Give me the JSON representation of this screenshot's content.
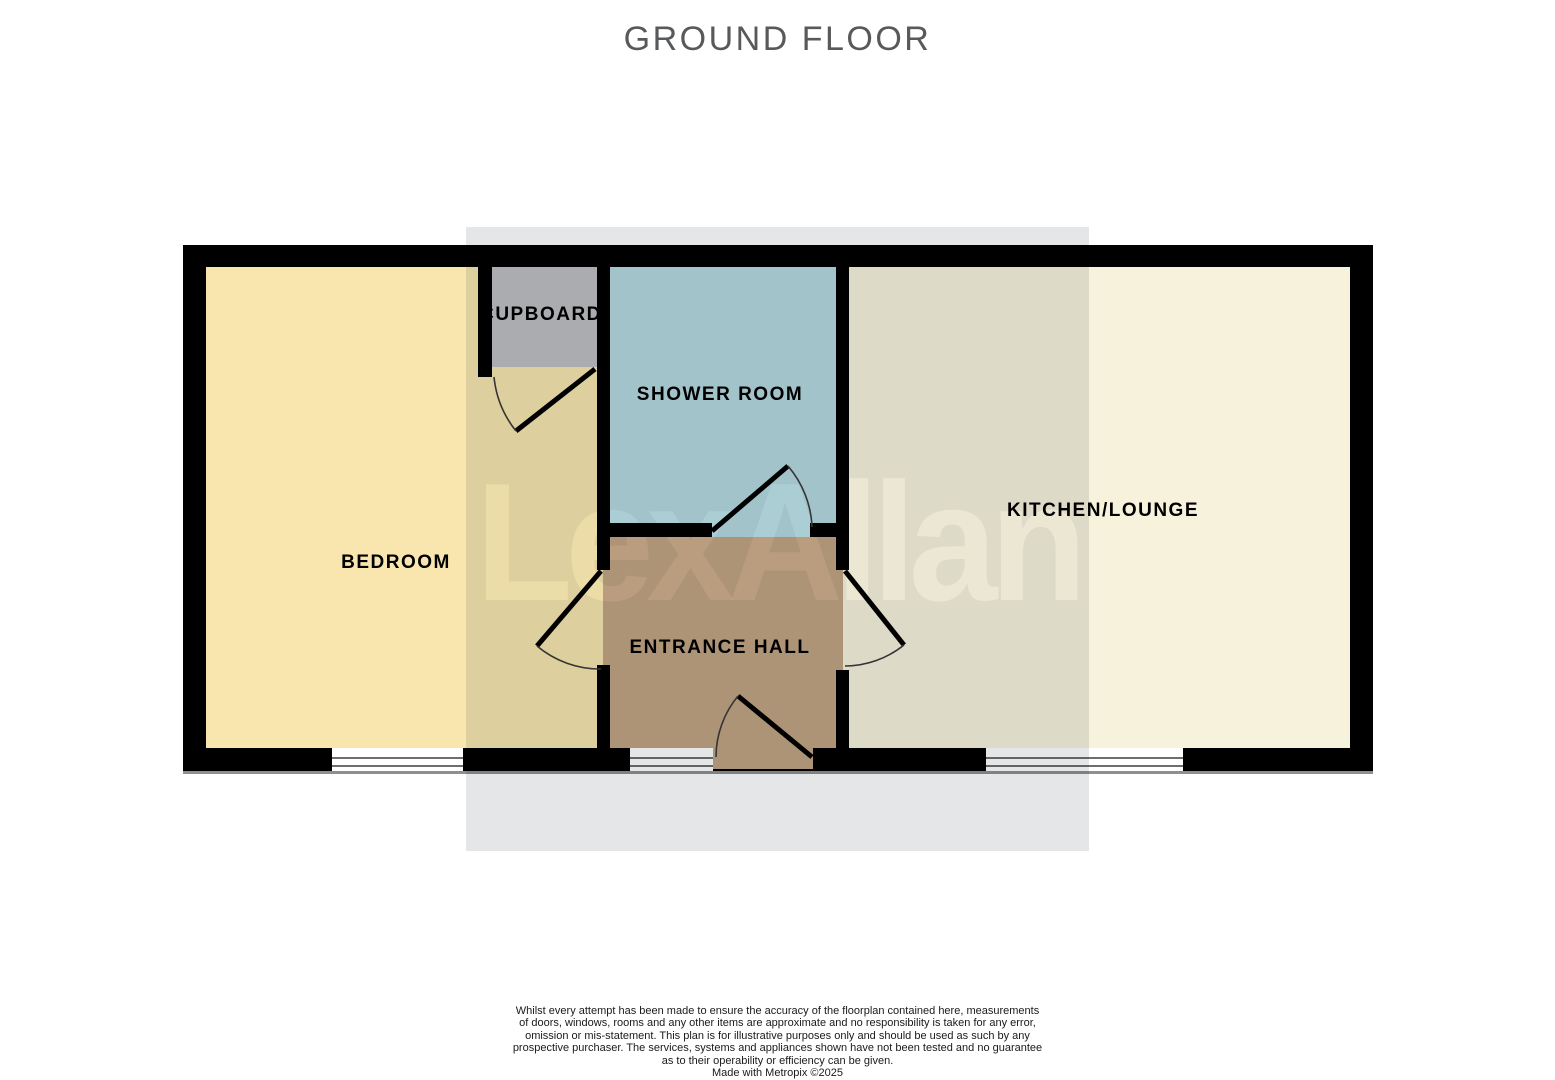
{
  "title": "GROUND FLOOR",
  "title_color": "#58595B",
  "floorplan": {
    "rooms": [
      {
        "name": "bedroom",
        "label": "BEDROOM",
        "color": "#F8E6AE"
      },
      {
        "name": "cupboard",
        "label": "CUPBOARD",
        "color": "#BFBFC1"
      },
      {
        "name": "shower-room",
        "label": "SHOWER ROOM",
        "color": "#B4D8DE"
      },
      {
        "name": "entrance-hall",
        "label": "ENTRANCE HALL",
        "color": "#C2A483"
      },
      {
        "name": "kitchen-lounge",
        "label": "KITCHEN/LOUNGE",
        "color": "#F7F2DC"
      }
    ],
    "wall_color": "#000000",
    "label_color": "#000000"
  },
  "watermark": {
    "text": "LexAllan",
    "square_color": "#E5E6E8"
  },
  "footer": {
    "lines": [
      "Whilst every attempt has been made to ensure the accuracy of the floorplan contained here, measurements",
      "of doors, windows, rooms and any other items are approximate and no responsibility is taken for any error,",
      "omission or mis-statement. This plan is for illustrative purposes only and should be used as such by any",
      "prospective purchaser. The services, systems and appliances shown have not been tested and no guarantee",
      "as to their operability or efficiency can be given.",
      "Made with Metropix ©2025"
    ]
  }
}
